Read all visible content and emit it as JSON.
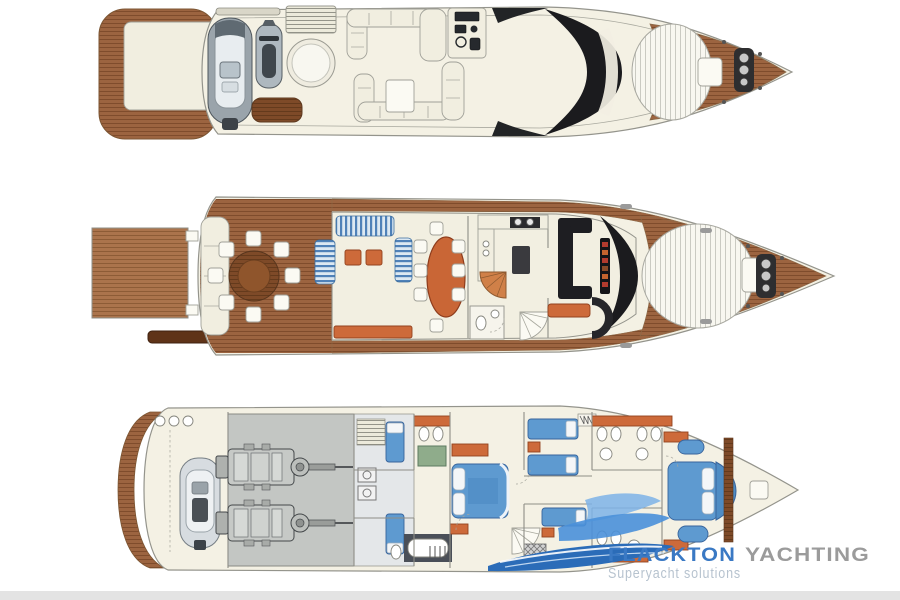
{
  "canvas": {
    "background": "#ffffff",
    "footer_bar_color": "#e3e3e3"
  },
  "palette": {
    "hull_fill": "#f4f1e4",
    "hull_stroke": "#94948c",
    "teak": "#9c6440",
    "teak_line": "#7c4a29",
    "teak_light": "#ab744c",
    "teak_dark": "#7e4a28",
    "furniture_orange": "#cd6a3a",
    "bed_blue": "#5e9ad0",
    "sofa_stripe_blue": "#4f81b8",
    "engine_room_gray": "#c3c6c3",
    "console_black": "#1b1b1e",
    "shower_green": "#8fac8b",
    "spa_fill": "#f8f7f0",
    "tender_gray": "#9aa4ab"
  },
  "watermark": {
    "brand_primary": "FLACKTON",
    "brand_secondary": "YACHTING",
    "tagline": "Superyacht solutions",
    "brand_primary_color": "#3a79c4",
    "brand_secondary_color": "#9b9b9b",
    "tagline_color": "#b7c3cf",
    "logo_blue_dark": "#2b6cb8",
    "logo_blue_mid": "#4a90d9",
    "logo_blue_light": "#7db3e8"
  }
}
